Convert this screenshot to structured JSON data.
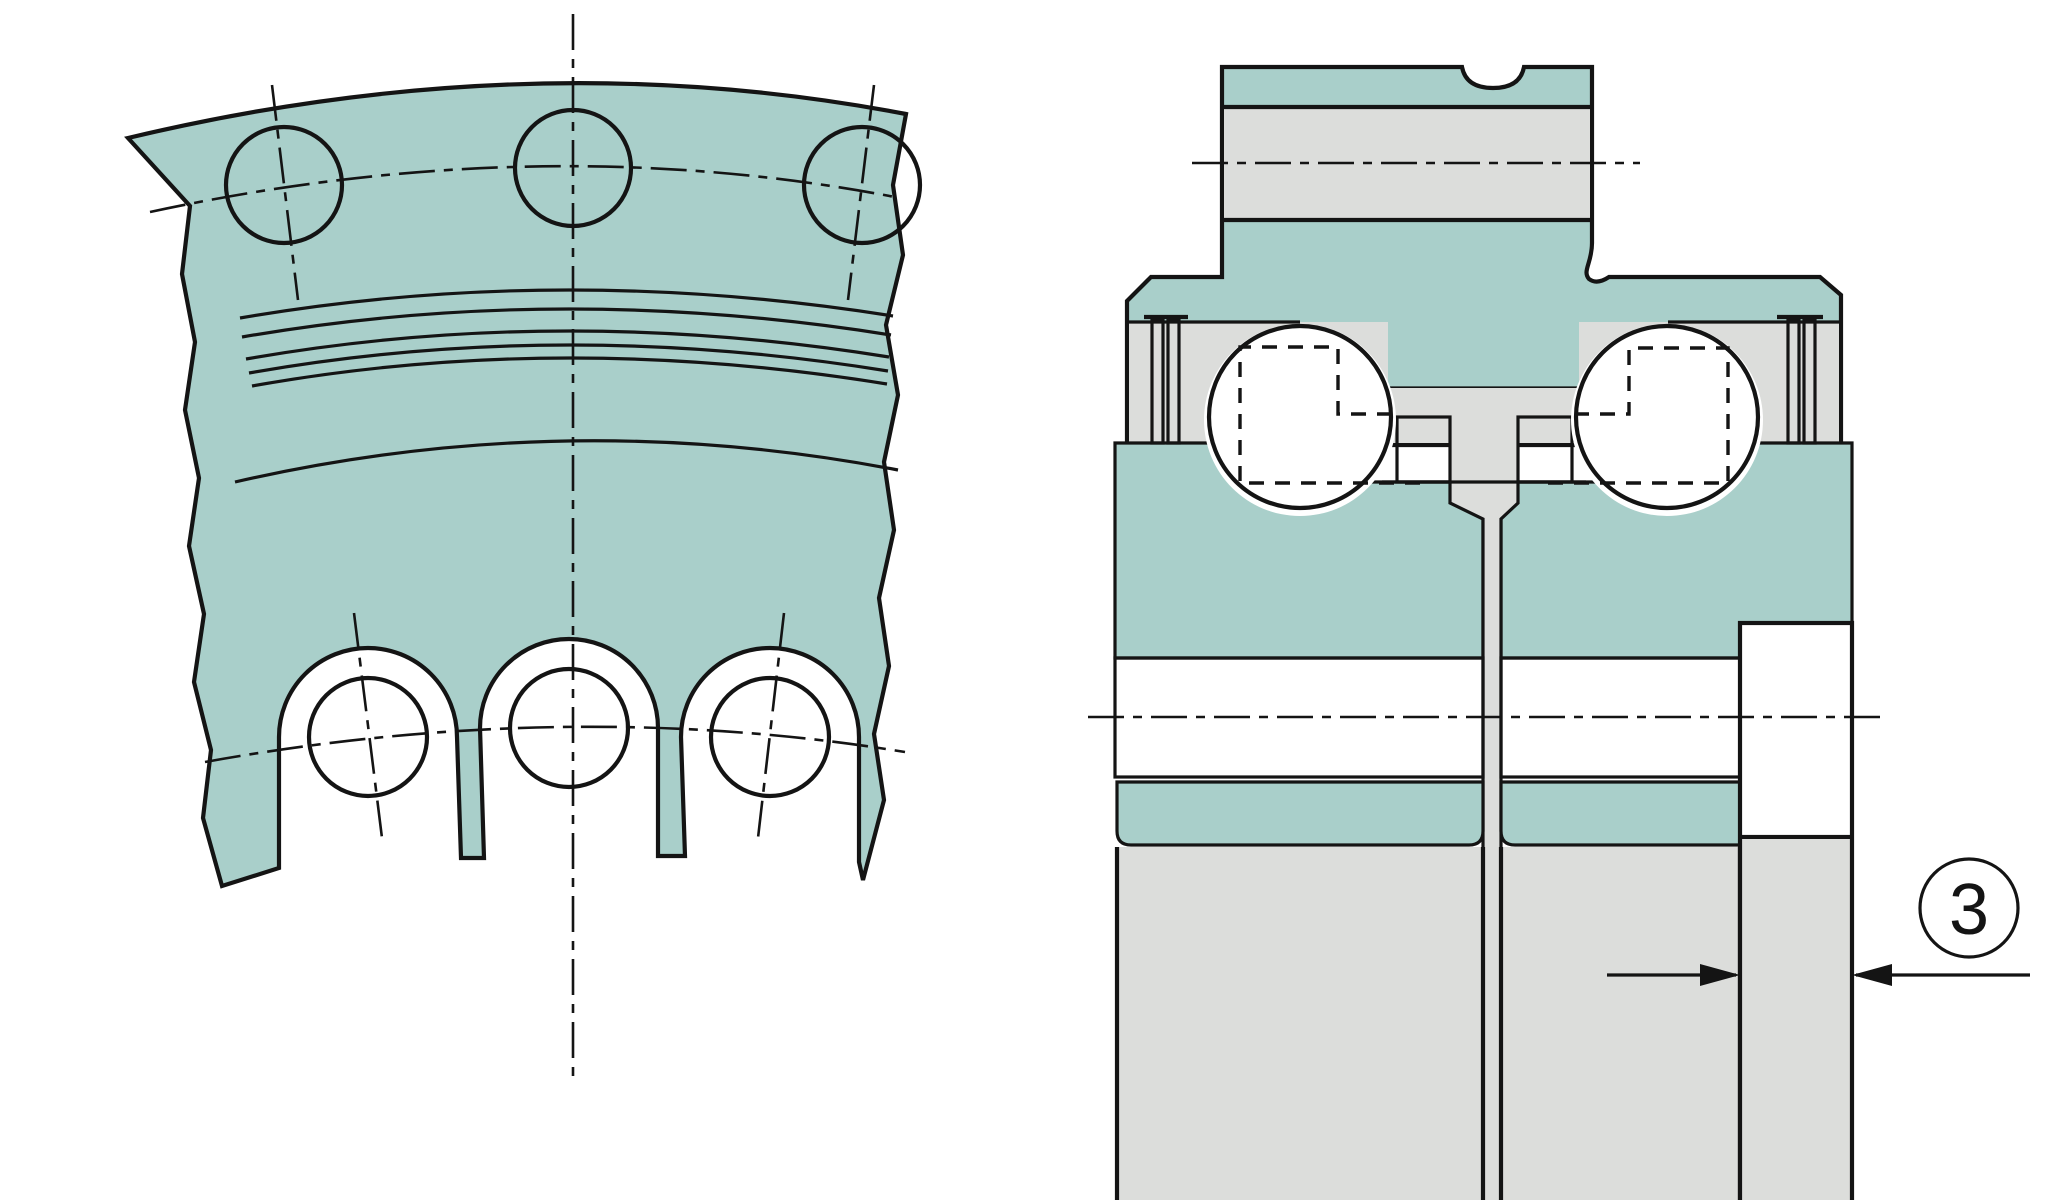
{
  "callout": {
    "label": "3"
  },
  "colors": {
    "background": "#ffffff",
    "line": "#141414",
    "metal_teal": "#a9cfca",
    "steel_gray": "#dcdddb",
    "cage_tan": "#eee2a4",
    "seal_pink": "#c8aeb6",
    "ball_highlight": "#ffffff",
    "ball_mid": "#ddeeea",
    "ball_edge": "#a2cac5"
  },
  "left_view": {
    "bolt_hole_count": 3,
    "lobe_count": 3,
    "groove_line_count": 5
  },
  "right_view": {
    "ball_count": 2,
    "seal_strip_count": 4,
    "cage_block_count": 2
  }
}
